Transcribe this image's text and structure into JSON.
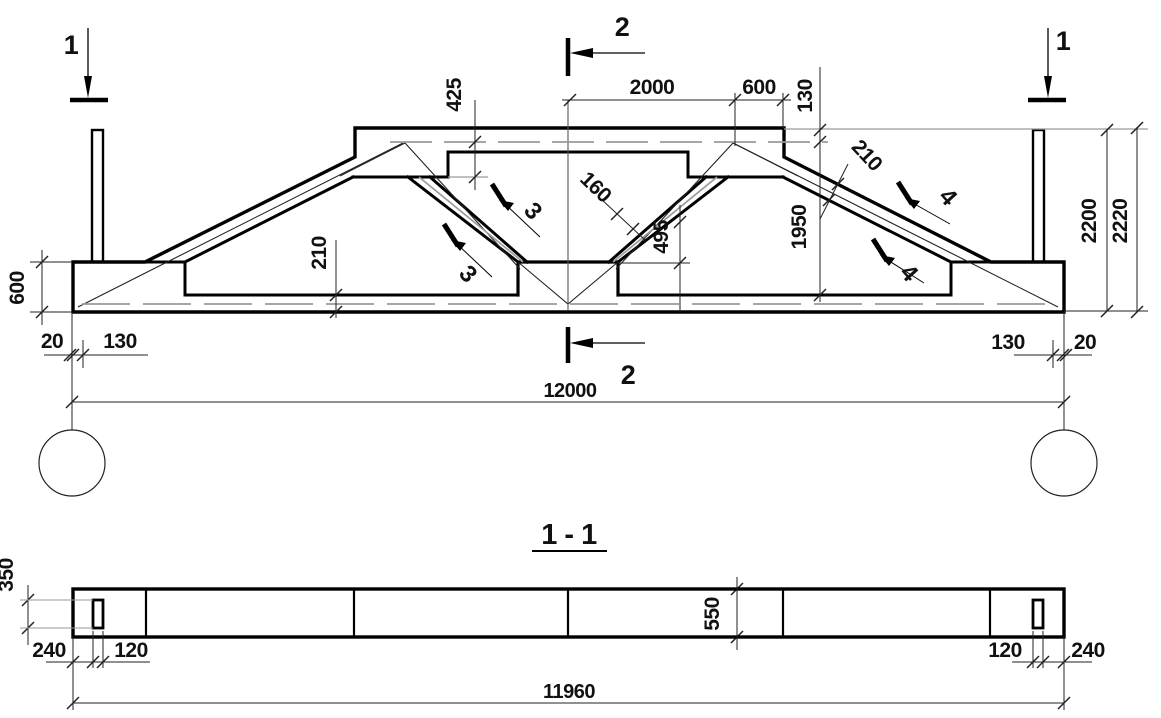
{
  "drawing": {
    "kind": "reinforced-concrete truss working drawing",
    "section_title": "1 - 1",
    "colors": {
      "line": "#000000",
      "thin_grey": "#9a9a9a",
      "background": "#ffffff"
    },
    "markers": {
      "s1": "1",
      "s2": "2",
      "s3": "3",
      "s4": "4"
    },
    "elevation_dims": {
      "top_panel": "2000",
      "top_end_panel": "600",
      "top_cover": "130",
      "top_chord_depth": "425",
      "diagonal_thickness": "160",
      "node_height": "495",
      "inner_height": "1950",
      "height_to_rebar": "2200",
      "overall_height": "2220",
      "end_block_height": "600",
      "bottom_chord_thickness": "210",
      "slope_chord_thickness": "210",
      "edge_left": "20",
      "bearing_left": "130",
      "bearing_right": "130",
      "edge_right": "20",
      "span": "12000"
    },
    "section_dims": {
      "plate_height": "350",
      "end_offset_left": "240",
      "plate_width_left": "120",
      "depth": "550",
      "plate_width_right": "120",
      "end_offset_right": "240",
      "length": "11960"
    }
  }
}
